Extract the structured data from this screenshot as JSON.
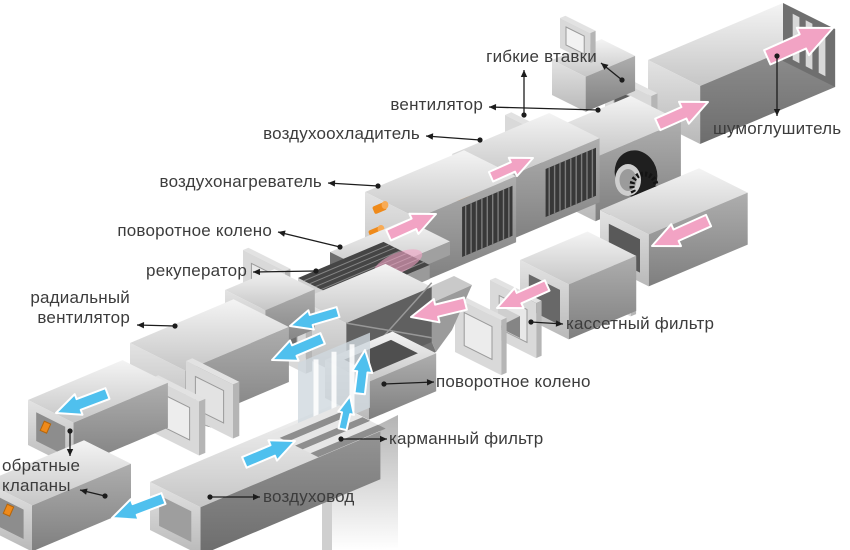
{
  "diagram": {
    "type": "exploded-isometric-ventilation-system",
    "language": "ru",
    "labels": {
      "flexible_inserts": "гибкие втавки",
      "fan": "вентилятор",
      "air_cooler": "воздухоохладитель",
      "air_heater": "воздухонагреватель",
      "turn_elbow_top": "поворотное колено",
      "recuperator": "рекуператор",
      "radial_fan": "радиальный\nвентилятор",
      "check_valves": "обратные\nклапаны",
      "silencer": "шумоглушитель",
      "cassette_filter": "кассетный фильтр",
      "turn_elbow_bottom": "поворотное колено",
      "pocket_filter": "карманный фильтр",
      "air_duct": "воздуховод"
    },
    "colors": {
      "supply_flow": "#4fc0ee",
      "supply_flow_edge": "#ffffff",
      "exhaust_flow": "#f2a3c4",
      "exhaust_flow_edge": "#ffffff",
      "pipe_orange": "#ef8a1a",
      "label_text": "#3c3c3c",
      "leader_line": "#1c1c1c",
      "background": "#ffffff"
    }
  }
}
